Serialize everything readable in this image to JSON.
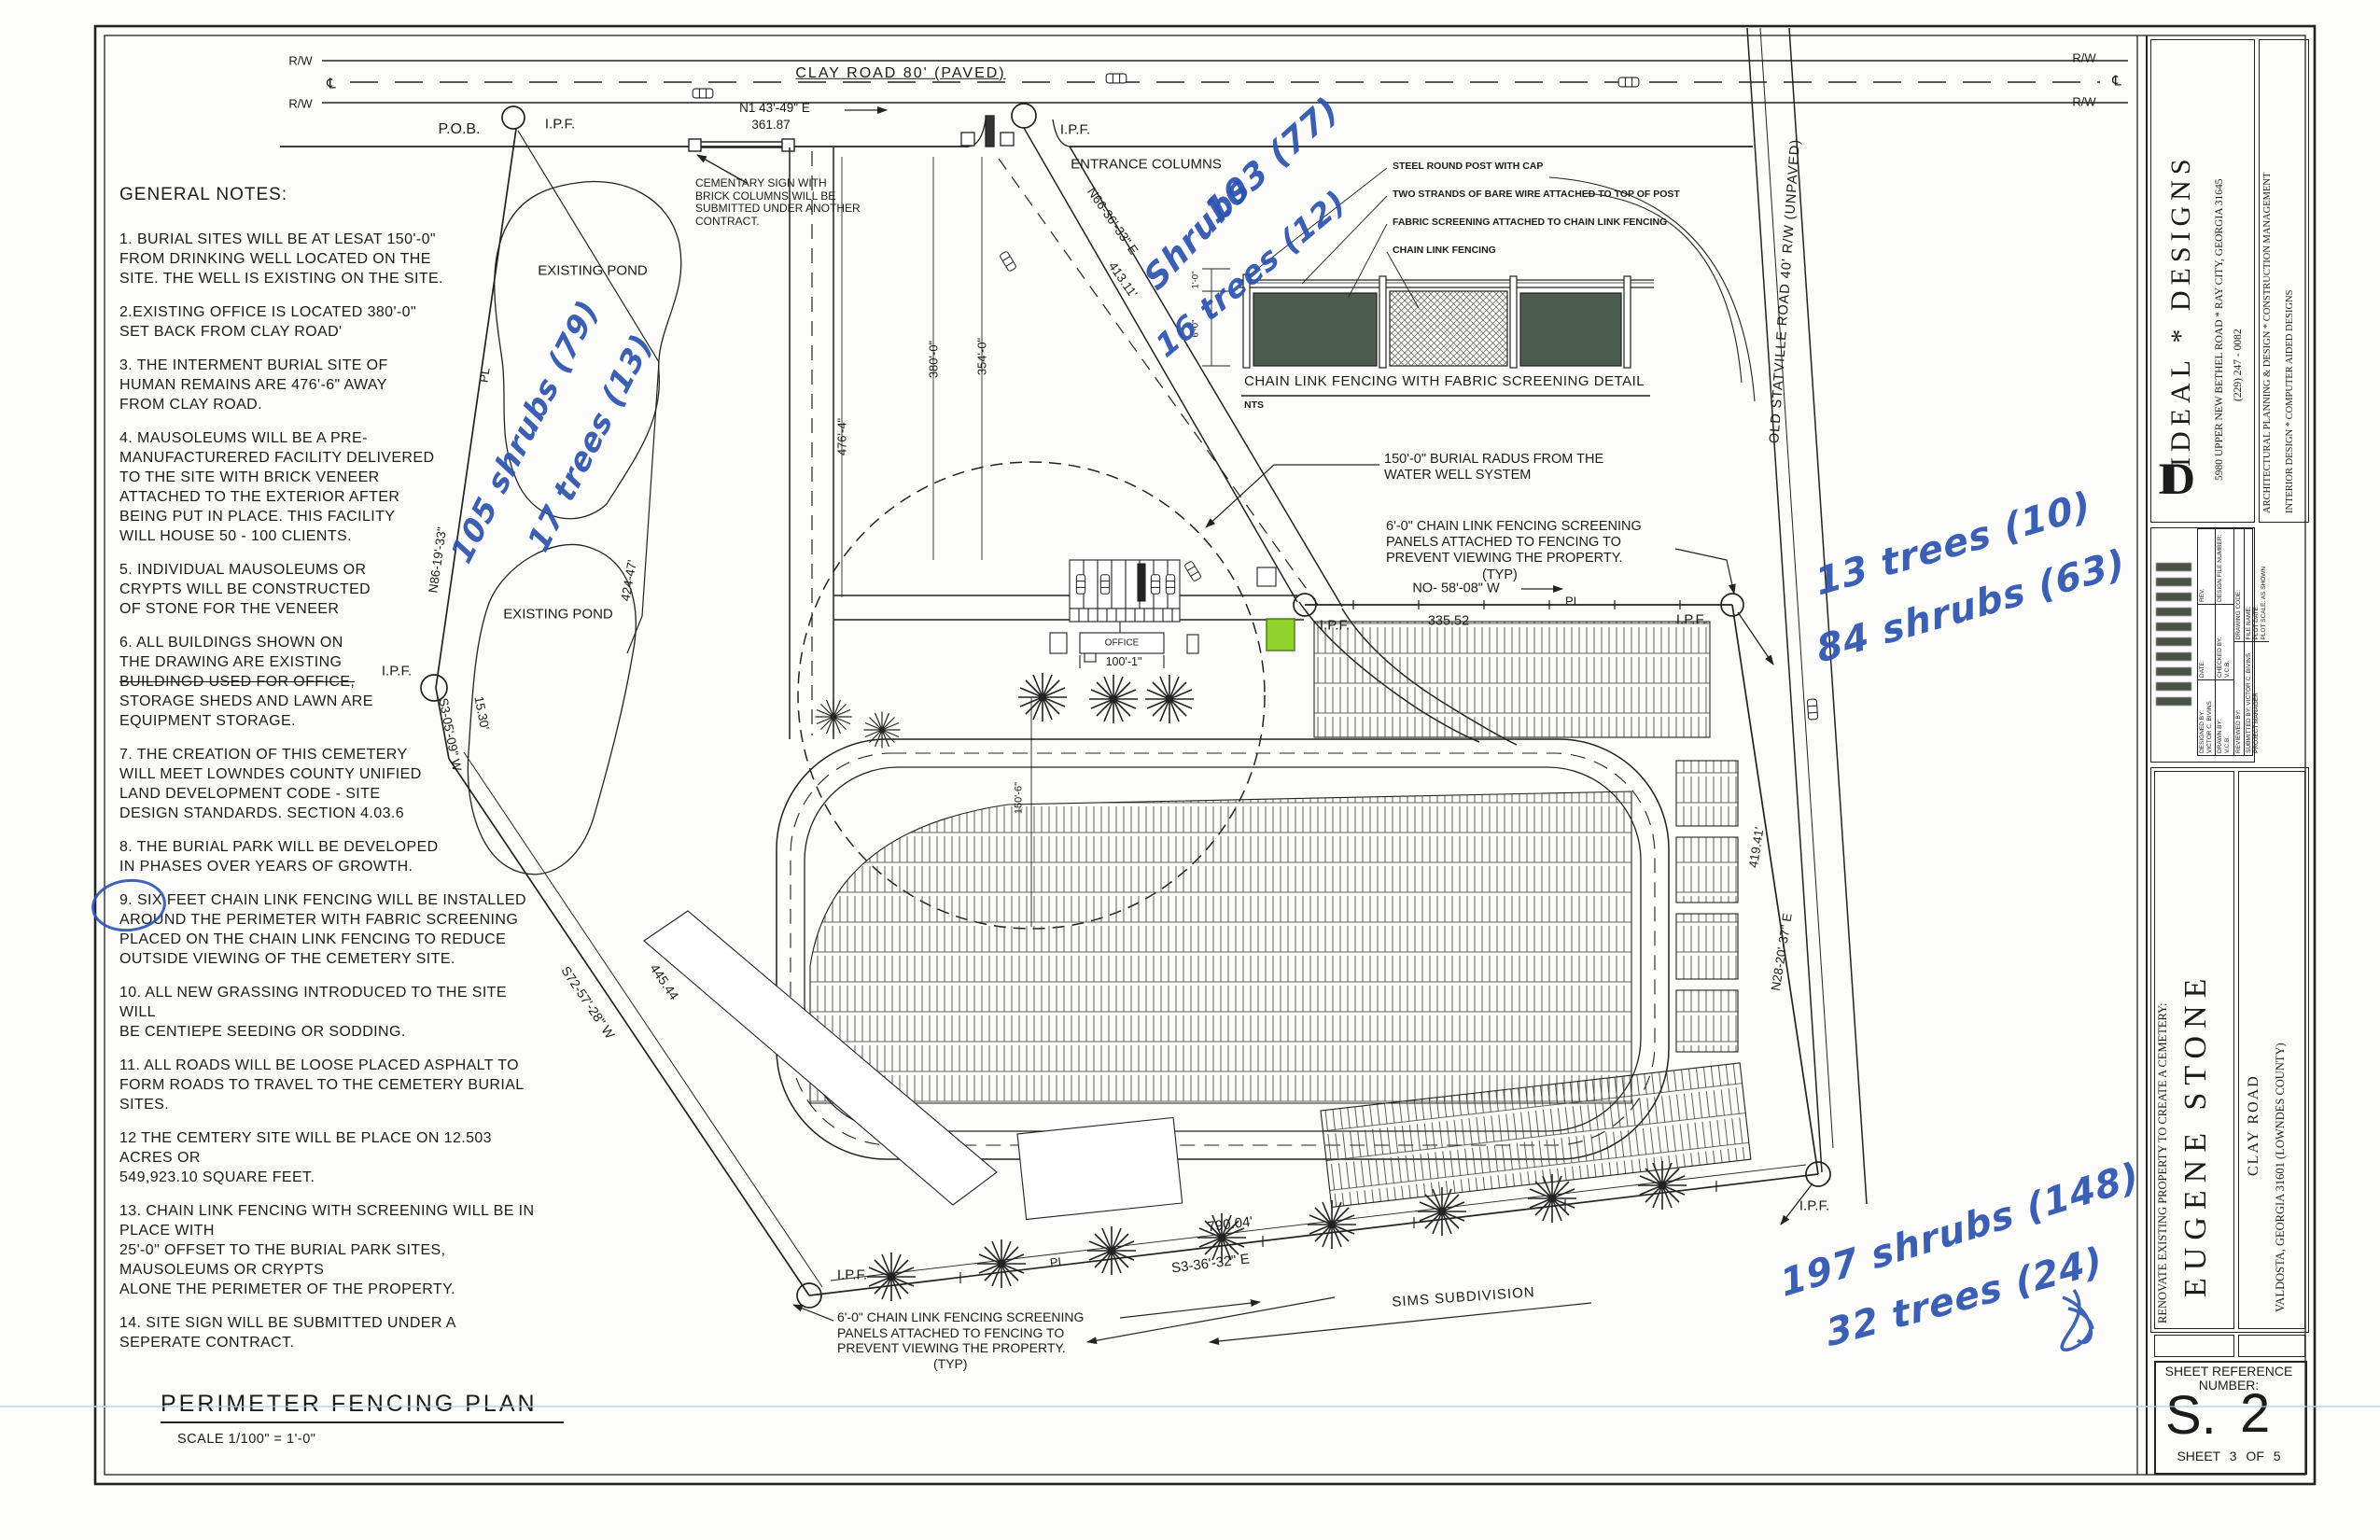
{
  "footer": {
    "plan_title": "PERIMETER FENCING PLAN",
    "plan_scale": "SCALE 1/100\" = 1'-0\""
  },
  "notes": {
    "title": "GENERAL NOTES:",
    "n1": "1. BURIAL SITES WILL BE AT LESAT 150'-0\"\nFROM DRINKING WELL LOCATED ON THE\nSITE.  THE WELL IS EXISTING ON THE SITE.",
    "n2": "2.EXISTING OFFICE IS LOCATED 380'-0\"\nSET BACK FROM CLAY ROAD'",
    "n3": "3. THE INTERMENT BURIAL SITE OF\nHUMAN REMAINS ARE 476'-6\" AWAY\nFROM CLAY ROAD.",
    "n4": "4. MAUSOLEUMS WILL BE A PRE-\nMANUFACTURERED FACILITY DELIVERED\nTO THE SITE WITH BRICK VENEER\nATTACHED TO THE EXTERIOR AFTER\nBEING PUT IN PLACE.  THIS FACILITY\nWILL HOUSE 50 - 100 CLIENTS.",
    "n5": "5. INDIVIDUAL MAUSOLEUMS OR\nCRYPTS WILL BE CONSTRUCTED\nOF STONE FOR THE VENEER",
    "n6_before": "6. ALL BUILDINGS SHOWN ON\nTHE DRAWING ARE EXISTING",
    "n6_struck": "BUILDINGD USED FOR OFFICE,",
    "n6_after": "STORAGE SHEDS AND LAWN ARE\nEQUIPMENT STORAGE.",
    "n7": "7. THE CREATION OF THIS CEMETERY\nWILL MEET LOWNDES COUNTY UNIFIED\nLAND DEVELOPMENT CODE - SITE\nDESIGN STANDARDS. SECTION 4.03.6",
    "n8": "8. THE BURIAL PARK WILL BE DEVELOPED\nIN PHASES OVER YEARS OF GROWTH.",
    "n9": "9.  SIX FEET CHAIN LINK FENCING WILL BE INSTALLED\nAROUND THE PERIMETER WITH FABRIC SCREENING\nPLACED ON THE CHAIN LINK FENCING TO REDUCE\nOUTSIDE VIEWING OF THE CEMETERY SITE.",
    "n10": "10. ALL NEW GRASSING INTRODUCED TO THE SITE WILL\nBE CENTIEPE SEEDING OR SODDING.",
    "n11": "11. ALL ROADS WILL BE LOOSE PLACED ASPHALT TO\nFORM ROADS TO TRAVEL TO THE CEMETERY BURIAL SITES.",
    "n12": "12 THE CEMTERY SITE WILL BE PLACE ON 12.503 ACRES OR\n549,923.10 SQUARE FEET.",
    "n13": "13. CHAIN LINK FENCING WITH SCREENING WILL BE IN PLACE WITH\n25'-0\" OFFSET TO THE BURIAL PARK SITES, MAUSOLEUMS OR CRYPTS\nALONE THE PERIMETER OF THE PROPERTY.",
    "n14": "14. SITE SIGN WILL BE SUBMITTED UNDER A SEPERATE CONTRACT."
  },
  "plan": {
    "clay_road": "CLAY ROAD  80' (PAVED)",
    "rw": "R/W",
    "cl": "℄",
    "pob": "P.O.B.",
    "ipf": "I.P.F.",
    "pl": "PL",
    "bearing_n1": "N1 43'-49\" E",
    "dist_361": "361.87",
    "sign_note": "CEMENTARY SIGN WITH\nBRICK COLUMNS WILL BE\nSUBMITTED UNDER ANOTHER\nCONTRACT.",
    "entrance_columns": "ENTRANCE COLUMNS",
    "existing_pond": "EXISTING POND",
    "bearing_n66": "N66-36'-33\" E",
    "dist_413": "413.11'",
    "dim_380": "380'-0\"",
    "dim_354": "354'-0\"",
    "dim_476": "476'-4\"",
    "bearing_n86": "N86-19'-33\"",
    "dist_424": "424-47'",
    "bearing_s3_05": "S3-05'-09\" W",
    "dist_15": "15.30'",
    "bearing_s72": "S72-57'-28\" W",
    "dist_445": "445.44",
    "radius_note": "150'-0\" BURIAL RADUS FROM THE\nWATER WELL SYSTEM",
    "screening_note": "6'-0\" CHAIN LINK FENCING SCREENING\nPANELS ATTACHED TO FENCING TO\nPREVENT VIEWING THE PROPERTY.",
    "typ": "(TYP)",
    "bearing_n0": "NO- 58'-08\" W",
    "dist_335": "335.52",
    "office": "OFFICE",
    "dim_100": "100'-1\"",
    "dim_150": "150'-6\"",
    "old_statville": "OLD STATVILLE ROAD 40' R/W (UNPAVED)",
    "bearing_n28": "N28-20'-37\" E",
    "dist_419": "419.41'",
    "bearing_s3_36": "S3-36'-32\" E",
    "dist_790": "790.04'",
    "sims": "SIMS SUBDIVISION"
  },
  "detail": {
    "l1": "STEEL ROUND POST WITH CAP",
    "l2": "TWO STRANDS OF BARE WIRE ATTACHED TO TOP OF POST",
    "l3": "FABRIC SCREENING ATTACHED TO CHAIN LINK FENCING",
    "l4": "CHAIN LINK FENCING",
    "dim_h": "1'-0\"",
    "dim_v": "6'-0\"",
    "title": "CHAIN LINK FENCING WITH FABRIC SCREENING DETAIL",
    "nts": "NTS"
  },
  "handwriting": {
    "left1": "105 shrubs (79)",
    "left2": "17 trees (13)",
    "top1": "103 (77)",
    "top2": "Shrubs",
    "top3": "16 trees (12)",
    "right1": "13 trees (10)",
    "right2": "84 shrubs (63)",
    "bottom1": "197 shrubs (148)",
    "bottom2": "32 trees (24)",
    "ink_color": "#2a52b0"
  },
  "title_block": {
    "logo": "ID",
    "firm": "IDEAL * DESIGNS",
    "address": "5980 UPPER NEW BETHEL ROAD * RAY CITY, GEORGIA 31645",
    "phone": "(229) 247 - 0082",
    "services1": "ARCHITECTURAL PLANNING & DESIGN * CONSTRUCTION MANAGEMENT",
    "services2": "INTERIOR DESIGN * COMPUTER AIDED DESIGNS",
    "designed_by_label": "DESIGNED BY:",
    "designed_by": "VICTOR C. BIVINS",
    "date_label": "DATE:",
    "rev_label": "REV.",
    "drawn_by_label": "DRAWN BY:",
    "drawn_by": "V.C.B.",
    "checked_by_label": "CHECKED BY:",
    "checked_by": "V.C.B.",
    "design_file_label": "DESIGN FILE NUMBER:",
    "reviewed_by_label": "REVIEWED BY:",
    "drawing_code_label": "DRAWING CODE:",
    "submitted_by_label": "SUBMITTED BY:",
    "submitted_by": "VICTOR C. BIVINS",
    "submitted_role": "PROJECT MANAGER",
    "file_name_label": "FILE NAME:",
    "plot_date_label": "PLOT DATE:",
    "plot_scale_label": "PLOT SCALE: AS SHOWN",
    "project": "RENOVATE EXISTING PROPERTY TO CREATE A CEMETERY:",
    "client": "EUGENE STONE",
    "road": "CLAY ROAD",
    "location": "VALDOSTA, GEORGIA 31601 (LOWNDES COUNTY)",
    "sheet_ref_label": "SHEET REFERENCE\nNUMBER:",
    "sheet_s": "S.",
    "sheet_num": "2",
    "sheet_of": "SHEET 3  OF  5"
  },
  "colors": {
    "ink_blue": "#2a52b0",
    "highlight_green": "#8cd122",
    "fabric_panel_green": "#4c5c4f"
  }
}
